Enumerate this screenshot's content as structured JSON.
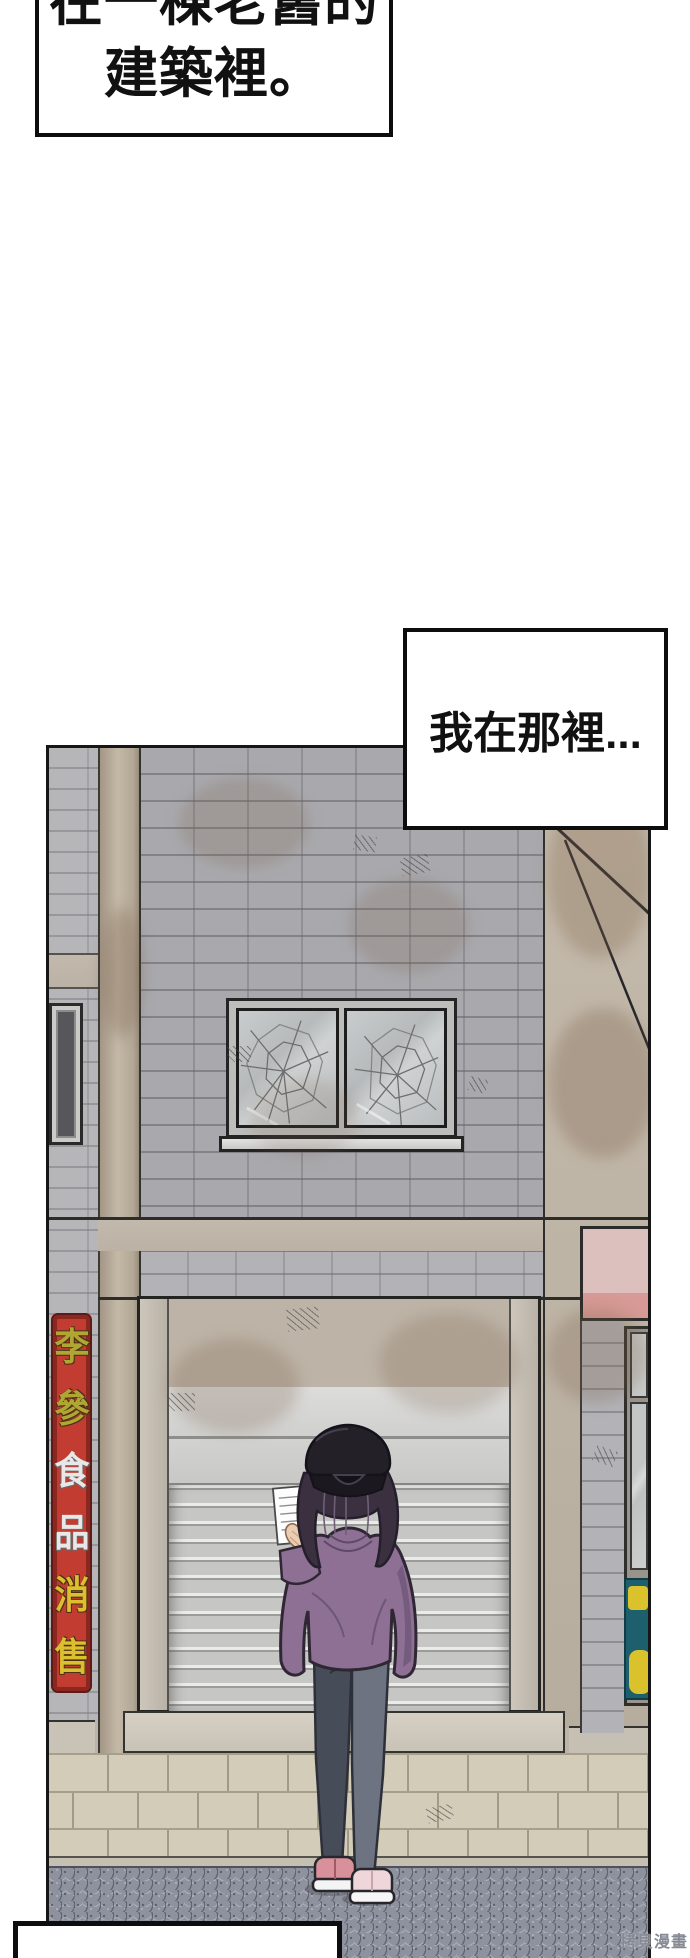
{
  "narration": {
    "top_box": {
      "line1": "在一棟老舊的",
      "line2": "建築裡。"
    },
    "mid_box": {
      "text": "我在那裡..."
    }
  },
  "building": {
    "left_sign": {
      "chars": [
        "李",
        "參",
        "食",
        "品",
        "消",
        "售"
      ]
    }
  },
  "watermark": {
    "text": "拷貝漫畫"
  },
  "colors": {
    "sign_red": "#c23c32",
    "sign_char_olive": "#b0a633",
    "sign_char_white": "#e8e8e8",
    "sign_char_yellow": "#ddbe2e",
    "pink_sign": "#d9bcb9",
    "teal_sign": "#1e5f6d",
    "teal_sign_yellow": "#d9c22c",
    "hoodie_purple": "#8e7095",
    "jeans_gray": "#6d7380",
    "shoe_pink": "#d8919a",
    "shoe_pale_pink": "#eed6db",
    "brick_gray": "#a9a9ad",
    "concrete_beige": "#bdb4a7",
    "road_gray": "#8e929e"
  }
}
